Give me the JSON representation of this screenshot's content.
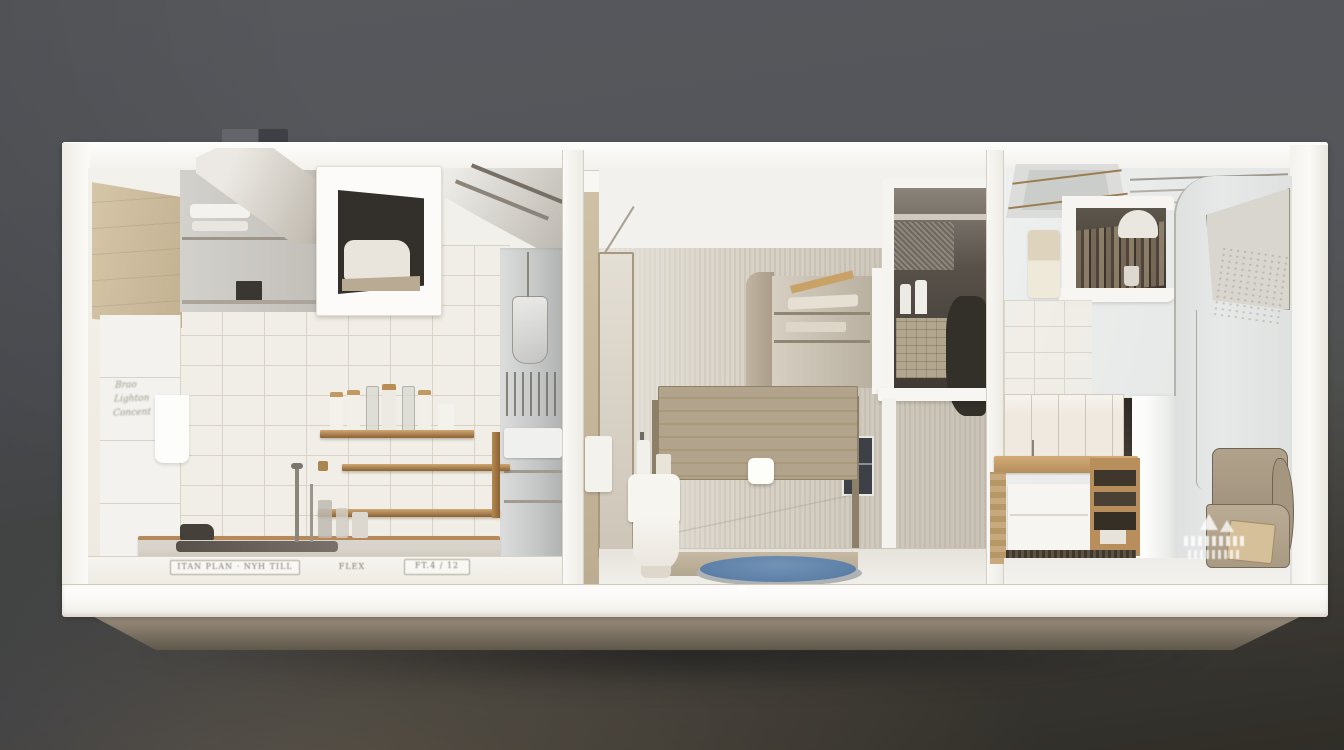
{
  "scene": {
    "type": "3d-apartment-cutaway-render",
    "description": "Photorealistic dollhouse cross-section of a narrow apartment floating on a dark backdrop: kitchen at left, bathroom in the middle, bedroom-study at right."
  },
  "rooms": [
    {
      "id": "kitchen",
      "side": "left"
    },
    {
      "id": "bathroom",
      "side": "center"
    },
    {
      "id": "bedroom-study",
      "side": "right"
    }
  ],
  "annotations": {
    "wall_note_lines": [
      "Brao",
      "Lighton",
      "Concent"
    ],
    "floor_mark_left": "ITAN PLAN · NYH TILL",
    "floor_mark_mid": "FLEX",
    "floor_mark_right": "FT.4 / 12"
  },
  "palette": {
    "bgTop": "#56585c",
    "bgMid": "#4e504f",
    "bgBottom": "#39362f",
    "shell": "#f8f7f4",
    "frameShade": "#efece5",
    "line": "#d5cfc3",
    "beige": "#cfc0a2",
    "tan": "#bcac92",
    "wood": "#ad8251",
    "woodLight": "#cfa873",
    "woodDark": "#8a6234",
    "tile": "#f1eee7",
    "tileLine": "#d9d2c6",
    "greigeA": "#cdc6ba",
    "greigeB": "#d8d2c7",
    "headboard": "#b2a38c",
    "headboardDark": "#a89979",
    "matBlue": "#5d80a8",
    "matBlueDark": "#44618a",
    "nicheDark": "#3f3a34",
    "chair": "#ab9d87",
    "cushion": "#d5c09a",
    "bevelTop": "#a39888",
    "bevelBottom": "#5f574b",
    "grayUnit": "#c9cbcb"
  }
}
